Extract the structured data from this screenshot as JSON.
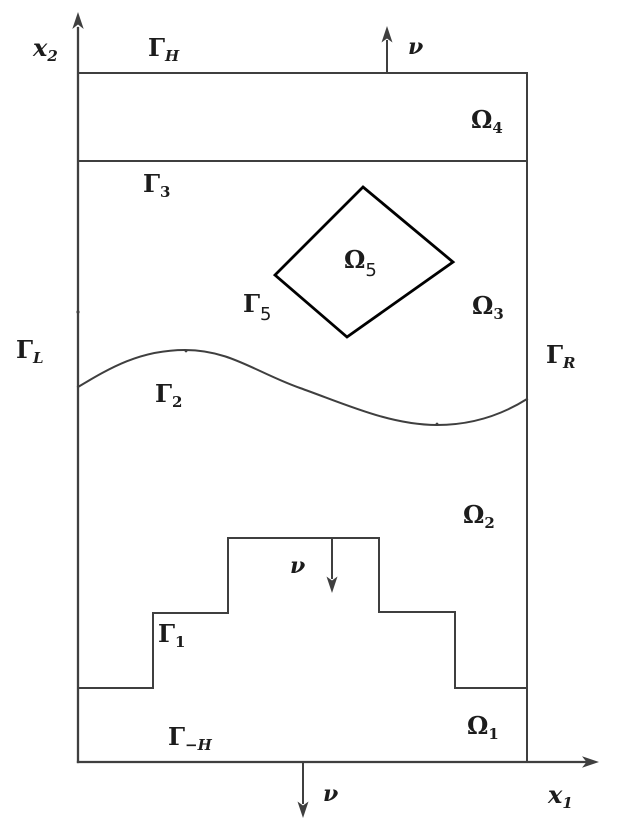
{
  "colors": {
    "line": "#3f3f3f",
    "diamond": "#000000",
    "label": "#1c1c1c"
  },
  "labels": {
    "x2_axis": {
      "main": "x",
      "sub": "2"
    },
    "x1_axis": {
      "main": "x",
      "sub": "1"
    },
    "gamma_H": {
      "main": "Γ",
      "sub": "H"
    },
    "gamma_minus_H": {
      "main": "Γ",
      "sub": "−H"
    },
    "gamma_L": {
      "main": "Γ",
      "sub": "L"
    },
    "gamma_R": {
      "main": "Γ",
      "sub": "R"
    },
    "gamma_1": {
      "main": "Γ",
      "sub": "1"
    },
    "gamma_2": {
      "main": "Γ",
      "sub": "2"
    },
    "gamma_3": {
      "main": "Γ",
      "sub": "3"
    },
    "gamma_5": {
      "main": "Γ",
      "sub": "5"
    },
    "omega_1": {
      "main": "Ω",
      "sub": "1"
    },
    "omega_2": {
      "main": "Ω",
      "sub": "2"
    },
    "omega_3": {
      "main": "Ω",
      "sub": "3"
    },
    "omega_4": {
      "main": "Ω",
      "sub": "4"
    },
    "omega_5": {
      "main": "Ω",
      "sub": "5"
    },
    "nu_top": "ν",
    "nu_middle": "ν",
    "nu_bottom": "ν"
  }
}
